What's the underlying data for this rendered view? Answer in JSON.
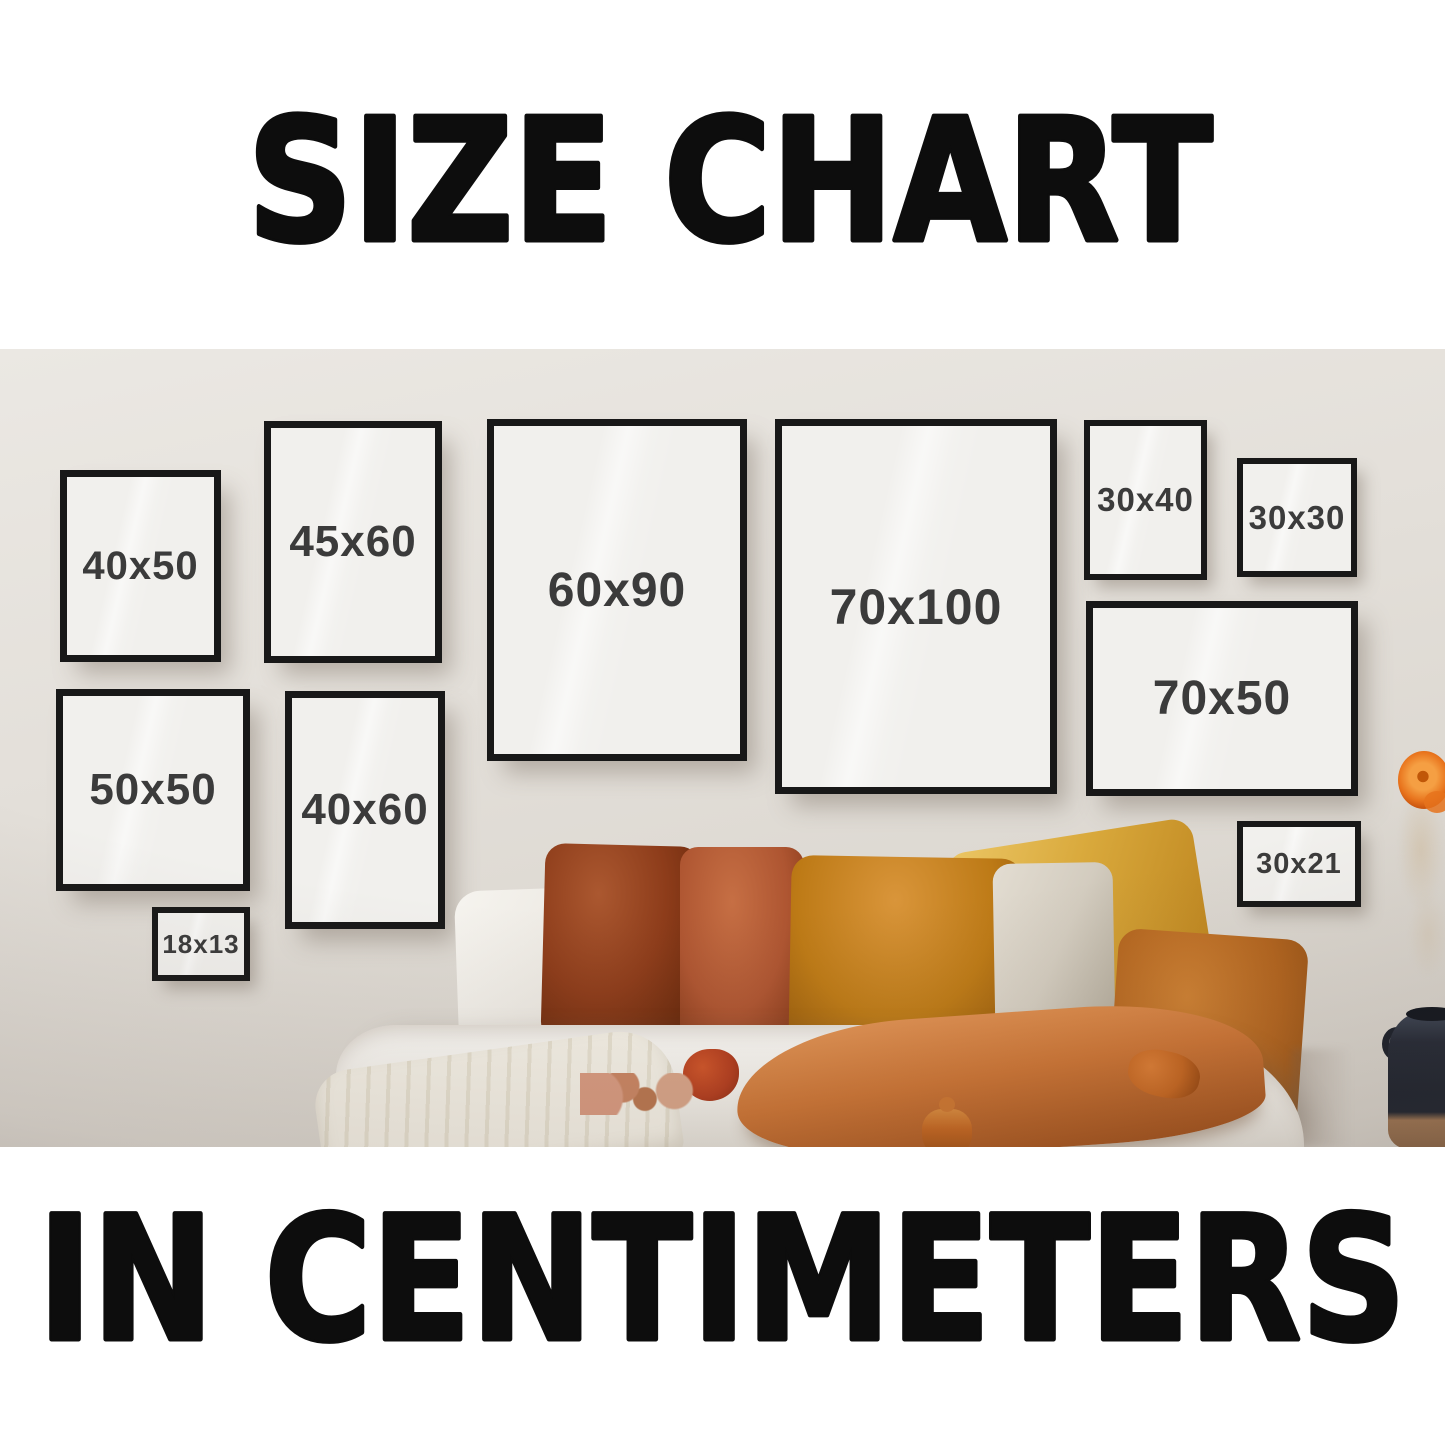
{
  "poster": {
    "title_top": "SIZE CHART",
    "title_bottom": "IN CENTIMETERS",
    "unit": "centimeters"
  },
  "frames": [
    {
      "label": "40x50"
    },
    {
      "label": "45x60"
    },
    {
      "label": "60x90"
    },
    {
      "label": "70x100"
    },
    {
      "label": "30x40"
    },
    {
      "label": "30x30"
    },
    {
      "label": "70x50"
    },
    {
      "label": "50x50"
    },
    {
      "label": "40x60"
    },
    {
      "label": "18x13"
    },
    {
      "label": "30x21"
    }
  ],
  "sizes_cm": [
    "40x50",
    "45x60",
    "60x90",
    "70x100",
    "30x40",
    "30x30",
    "70x50",
    "50x50",
    "40x60",
    "18x13",
    "30x21"
  ],
  "colors": {
    "band_bg": "#ffffff",
    "title_ink": "#0d0d0d",
    "wall_top": "#ebe8e3",
    "wall_mid": "#e3dfd9",
    "wall_bottom": "#d5d0c8",
    "frame_border": "#181818",
    "frame_fill": "#f1f0ed",
    "frame_text": "#3b3b3b",
    "pillow_white": "#f6f4ef",
    "pillow_rust": "#8d3c1a",
    "pillow_rust_hi": "#ab5830",
    "pillow_rust_lo": "#5f2408",
    "pillow_terracotta": "#ae5531",
    "pillow_terracotta_hi": "#c66f44",
    "pillow_amber": "#bd7a16",
    "pillow_amber_hi": "#d9953a",
    "pillow_amber_lo": "#8f5409",
    "pillow_mustard": "#d9a93c",
    "pillow_mustard_hi": "#ecc766",
    "pillow_mustard_lo": "#bc831d",
    "pillow_cream": "#d3ccbf",
    "pillow_cream_hi": "#e3ddd2",
    "pillow_cream_lo": "#b2aa9a",
    "pillow_orange": "#b2641e",
    "pillow_orange_hi": "#cd8032",
    "pillow_orange_lo": "#8d4c12",
    "front_pillow": "#cc7434",
    "front_pillow_hi": "#e19354",
    "front_pillow_lo": "#a2511b",
    "bedding": "#f2efe9",
    "bedding_hi": "#fbfaf7",
    "bedding_lo": "#e3dfd7",
    "blanket": "#f4f0e6",
    "blanket_lo": "#e6e0d0",
    "tassel_red": "#b23c1d",
    "tassel_orange": "#c4651f",
    "vase_body": "#232834",
    "vase_hi": "#3d4554",
    "vase_base": "#9a7250",
    "flower_orange": "#e8731c",
    "flower_orange_hi": "#f59f43",
    "sprig_pink": "#d89a80"
  }
}
